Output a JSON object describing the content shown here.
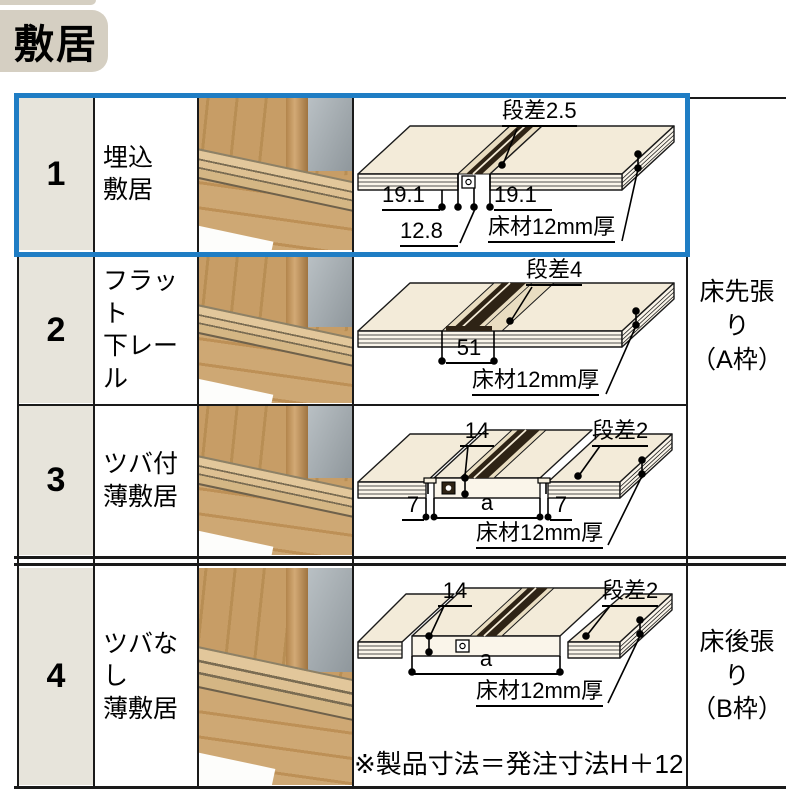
{
  "title": {
    "badge": "敷居"
  },
  "rows": [
    {
      "num": "1",
      "name_line1": "埋込",
      "name_line2": "敷居",
      "diagram": {
        "step": "段差2.5",
        "dim_left": "19.1",
        "dim_right": "19.1",
        "dim_bottom": "12.8",
        "floor": "床材12mm厚"
      }
    },
    {
      "num": "2",
      "name_line1": "フラット",
      "name_line2": "下レール",
      "diagram": {
        "step": "段差4",
        "dim_center": "51",
        "floor": "床材12mm厚"
      }
    },
    {
      "num": "3",
      "name_line1": "ツバ付",
      "name_line2": "薄敷居",
      "diagram": {
        "dim_top": "14",
        "step": "段差2",
        "dim_left": "7",
        "dim_center": "a",
        "dim_right": "7",
        "floor": "床材12mm厚"
      }
    },
    {
      "num": "4",
      "name_line1": "ツバなし",
      "name_line2": "薄敷居",
      "diagram": {
        "dim_top": "14",
        "step": "段差2",
        "dim_center": "a",
        "floor": "床材12mm厚"
      }
    }
  ],
  "sections": {
    "a_line1": "床先張り",
    "a_line2": "（A枠）",
    "b_line1": "床後張り",
    "b_line2": "（B枠）"
  },
  "note": "※製品寸法＝発注寸法H＋12",
  "colors": {
    "highlight_blue": "#1f7dc4",
    "header_bg": "#d5cfc2",
    "num_cell_bg": "#e7e4db",
    "line_black": "#1a1a1a"
  }
}
